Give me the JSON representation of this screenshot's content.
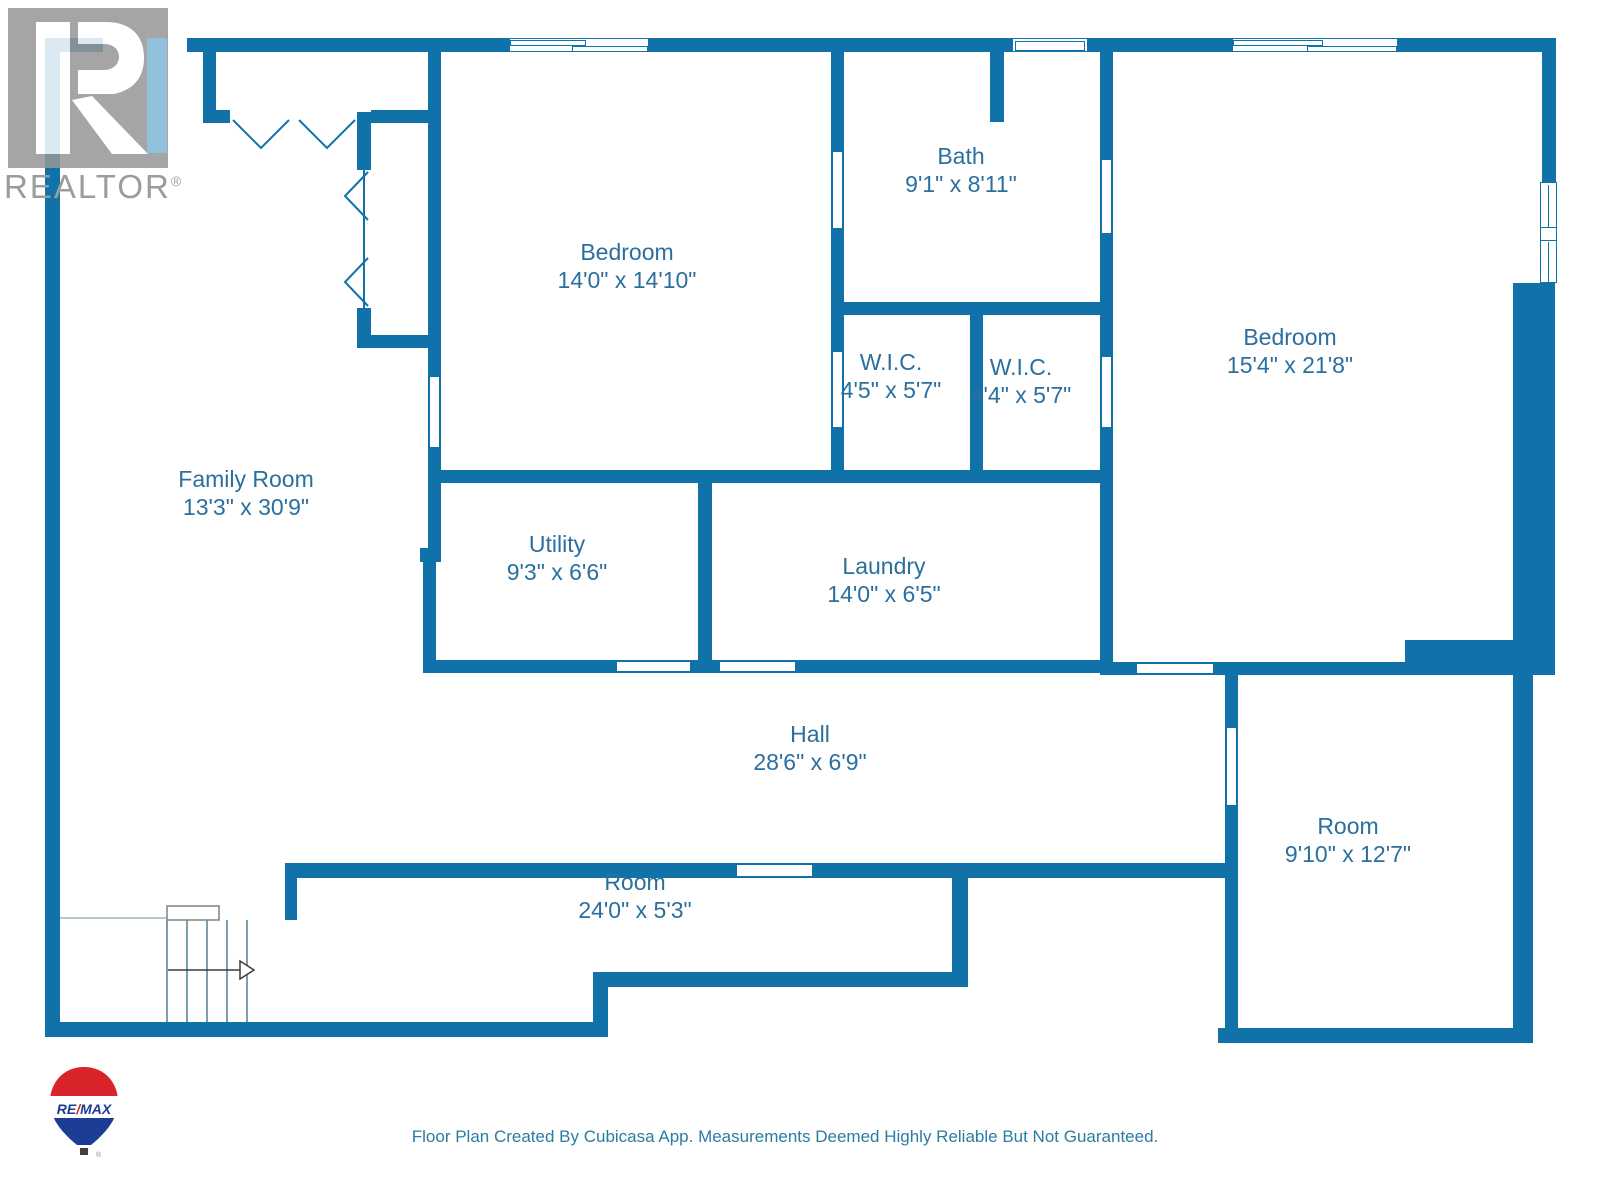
{
  "title": "Floor Plan",
  "colors": {
    "wall": "#1172AA",
    "label": "#2A6F9E",
    "footer": "#2B7CA3",
    "realtor_gray": "#9C9C9C",
    "logo_block": "#969696",
    "logo_stripe": "#8FC3E3",
    "remax_red": "#D8232A",
    "remax_blue": "#1B3E94",
    "stair_line": "#4F7D99",
    "arrow": "#3C3C3C"
  },
  "rooms": [
    {
      "name": "Bedroom",
      "dims": "14'0\" x 14'10\""
    },
    {
      "name": "Bath",
      "dims": "9'1\" x 8'11\""
    },
    {
      "name": "W.I.C.",
      "dims": "4'5\" x 5'7\""
    },
    {
      "name": "W.I.C.",
      "dims": "4'4\" x 5'7\""
    },
    {
      "name": "Bedroom",
      "dims": "15'4\" x 21'8\""
    },
    {
      "name": "Family Room",
      "dims": "13'3\" x 30'9\""
    },
    {
      "name": "Utility",
      "dims": "9'3\" x 6'6\""
    },
    {
      "name": "Laundry",
      "dims": "14'0\" x 6'5\""
    },
    {
      "name": "Hall",
      "dims": "28'6\" x 6'9\""
    },
    {
      "name": "Room",
      "dims": "24'0\" x 5'3\""
    },
    {
      "name": "Room",
      "dims": "9'10\" x 12'7\""
    }
  ],
  "watermarks": {
    "realtor": {
      "text": "REALTOR",
      "reg": "®"
    },
    "remax": {
      "part1": "RE",
      "slash": "/",
      "part2": "MAX",
      "reg": "®"
    }
  },
  "footer": {
    "text": "Floor Plan Created By Cubicasa App. Measurements Deemed Highly Reliable But Not Guaranteed."
  }
}
